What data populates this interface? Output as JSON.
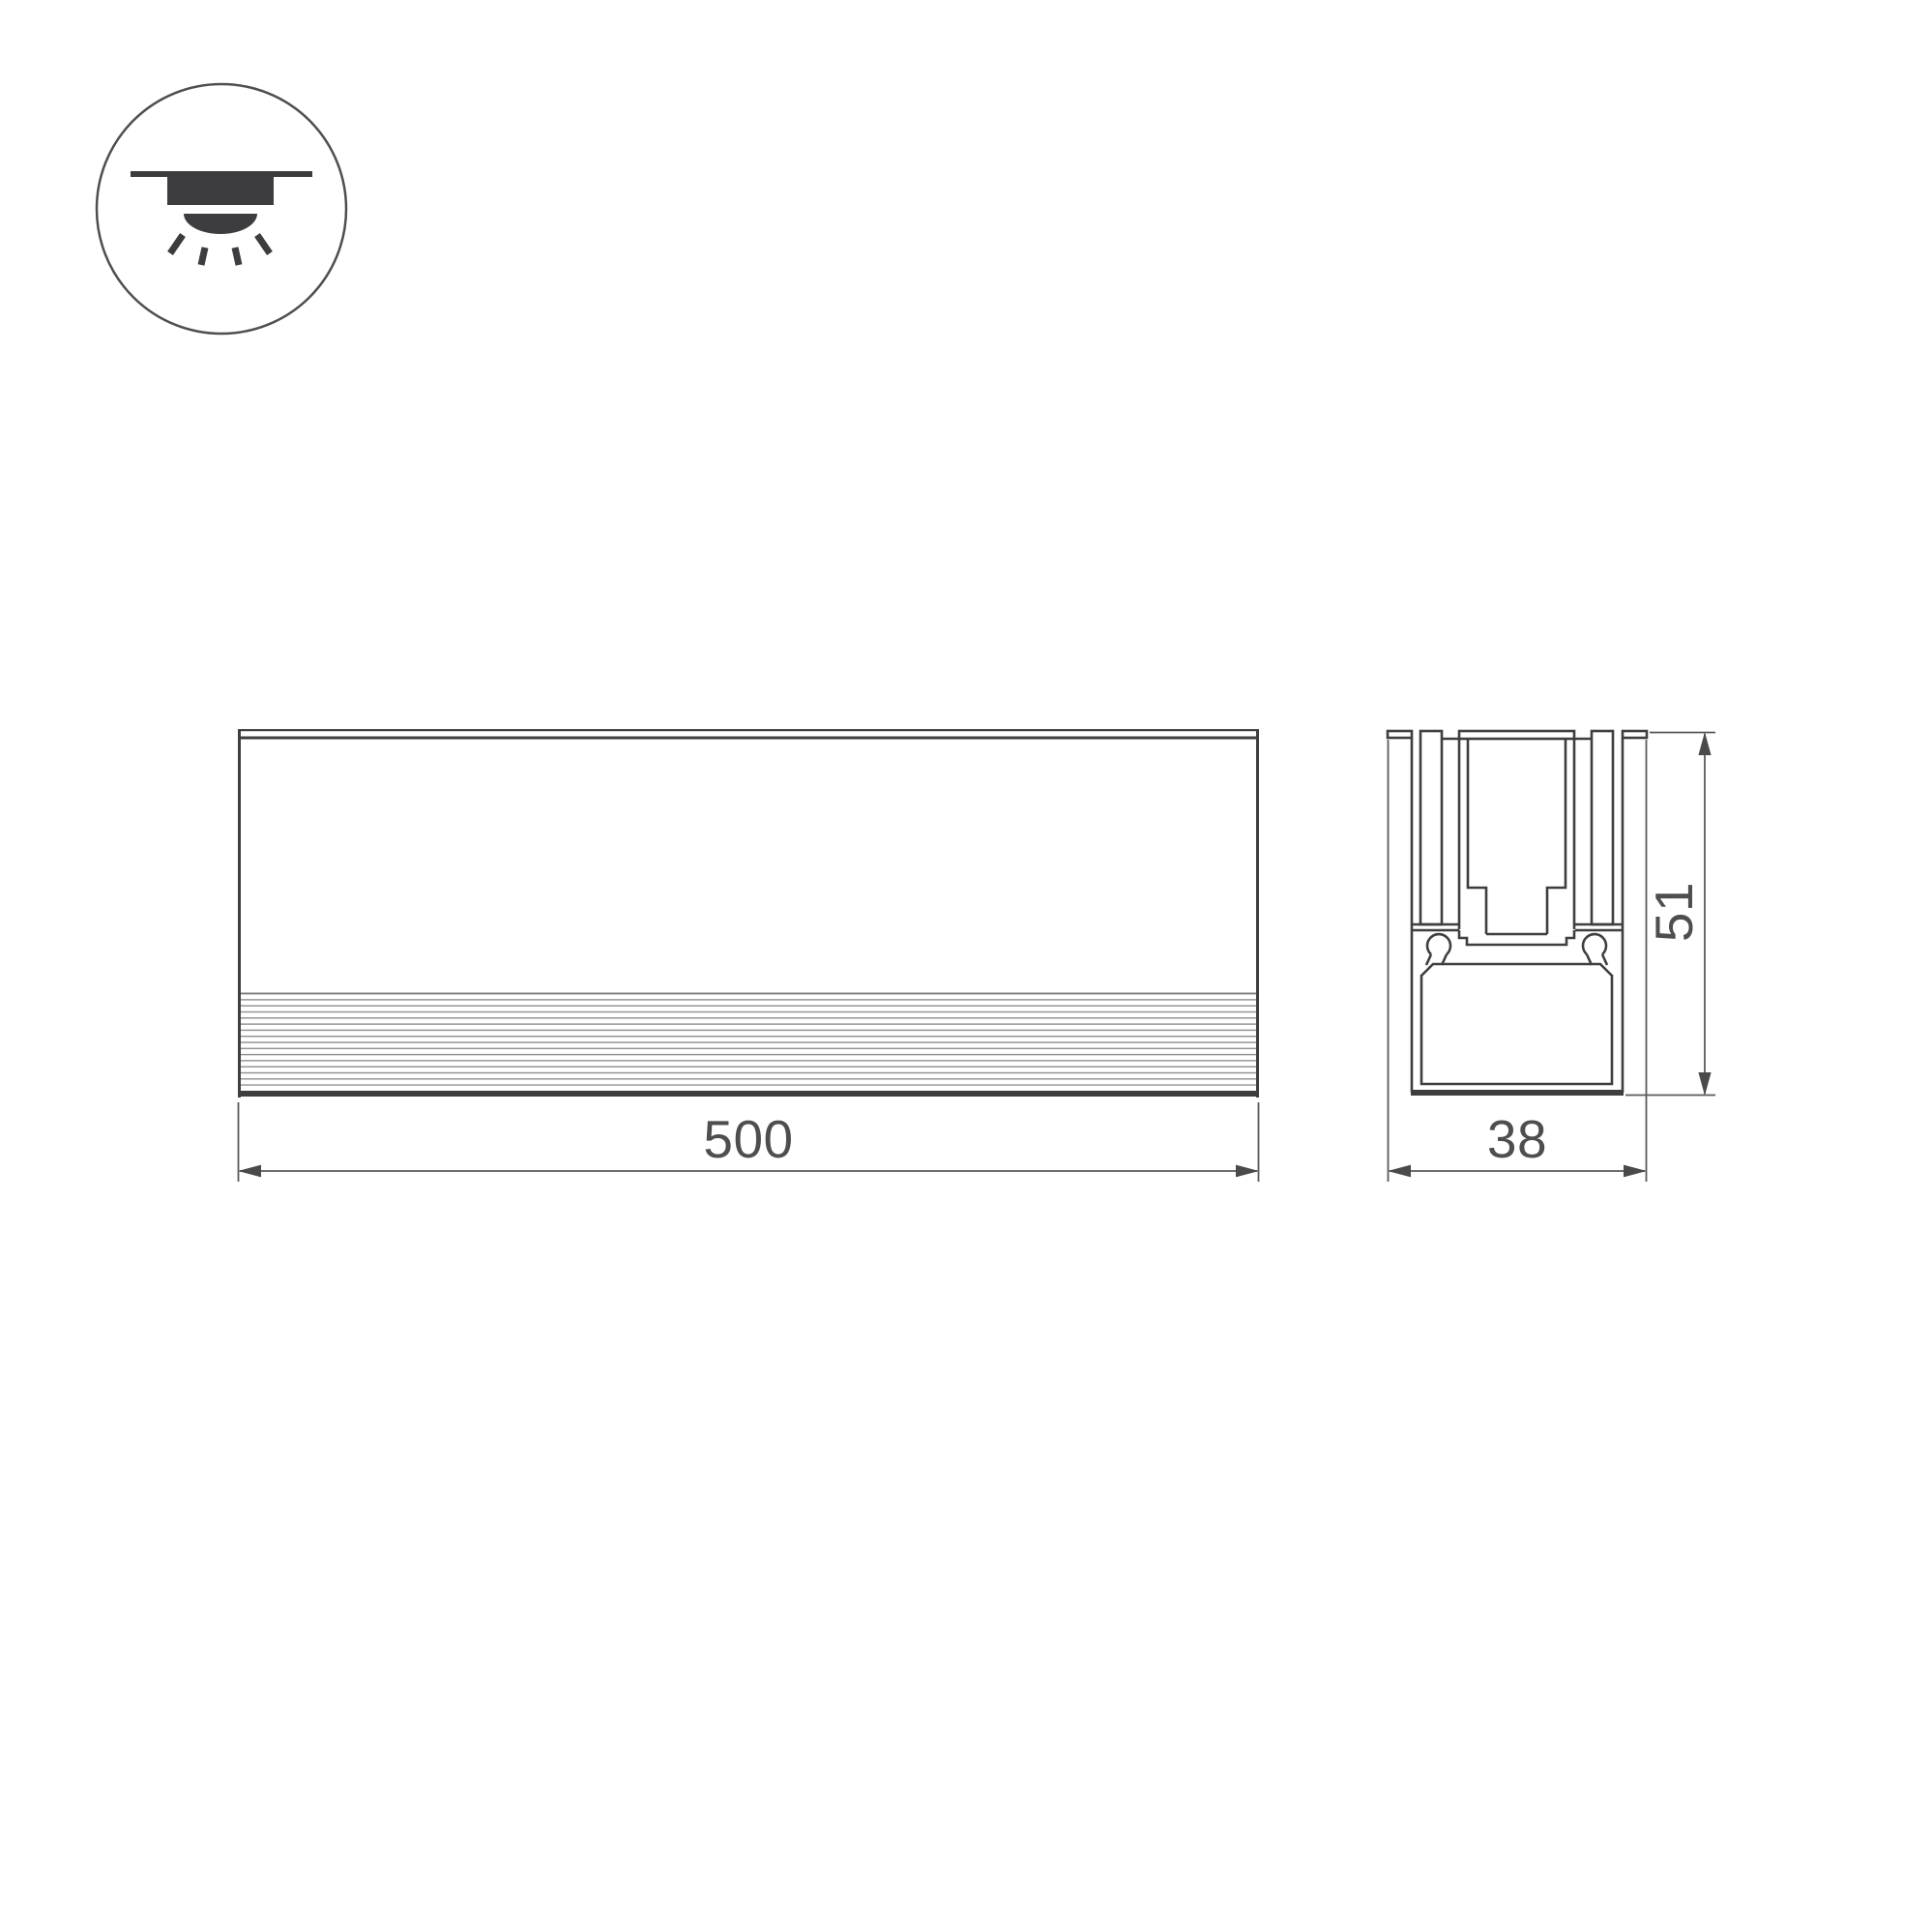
{
  "drawing": {
    "kind": "technical-dimension-drawing",
    "views": {
      "front_view": {
        "name": "front-view",
        "length_label": "500"
      },
      "section_view": {
        "name": "cross-section-view",
        "width_label": "38",
        "height_label": "51"
      }
    },
    "labels": {
      "front_length": "500",
      "section_width": "38",
      "section_height": "51"
    },
    "icons": {
      "mount": "recessed-ceiling-downlight-icon"
    },
    "colors": {
      "background": "#ffffff",
      "profile_line": "#3e3e3e",
      "dimension_line": "#5a5a5a",
      "label_text": "#4e4e4e",
      "rib_line": "#8f8f8f",
      "icon_fill": "#3d3d40",
      "icon_circle_stroke": "#4f4f4f"
    }
  }
}
